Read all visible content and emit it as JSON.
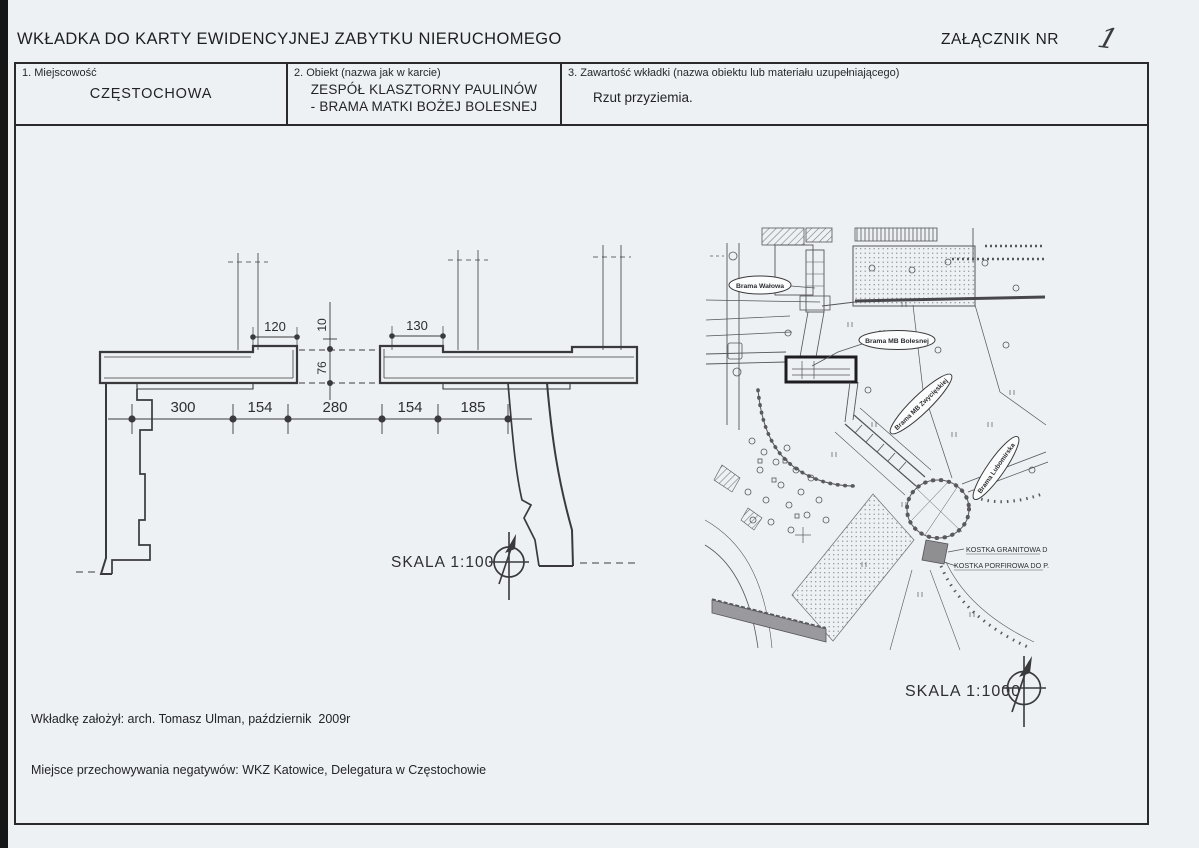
{
  "page": {
    "title": "WKŁADKA DO KARTY EWIDENCYJNEJ ZABYTKU NIERUCHOMEGO",
    "attachment": {
      "label": "ZAŁĄCZNIK NR",
      "number": "1"
    }
  },
  "fields": {
    "locality": {
      "label": "1. Miejscowość",
      "value": "CZĘSTOCHOWA"
    },
    "object": {
      "label": "2. Obiekt (nazwa jak w karcie)",
      "value_line1": "ZESPÓŁ KLASZTORNY PAULINÓW",
      "value_line2": "- BRAMA MATKI BOŻEJ BOLESNEJ"
    },
    "content": {
      "label": "3. Zawartość wkładki (nazwa obiektu lub materiału uzupełniającego)",
      "value": "Rzut przyziemia."
    }
  },
  "plan": {
    "scale_label": "SKALA 1:100",
    "dims": {
      "pier_left": "120",
      "pier_right": "130",
      "vert_small": "10",
      "vert_large": "76",
      "axis": [
        "300",
        "154",
        "280",
        "154",
        "185"
      ]
    }
  },
  "map": {
    "scale_label": "SKALA 1:1000",
    "labels": {
      "walowa": "Brama Wałowa",
      "bolesnej": "Brama MB Bolesnej",
      "zwycieskiej": "Brama MB Zwycięskiej",
      "lubomirska": "Brama Lubomirska",
      "kostka_granitowa": "KOSTKA GRANITOWA D",
      "kostka_porfirowa": "KOSTKA PORFIROWA DO P."
    }
  },
  "footer": {
    "line1": "Wkładkę założył: arch. Tomasz Ulman, październik  2009r",
    "line2": "Miejsce przechowywania negatywów: WKZ Katowice, Delegatura w Częstochowie"
  },
  "colors": {
    "paper": "#edf1f3",
    "ink": "#2e2e31",
    "line": "#3a3a3d"
  }
}
